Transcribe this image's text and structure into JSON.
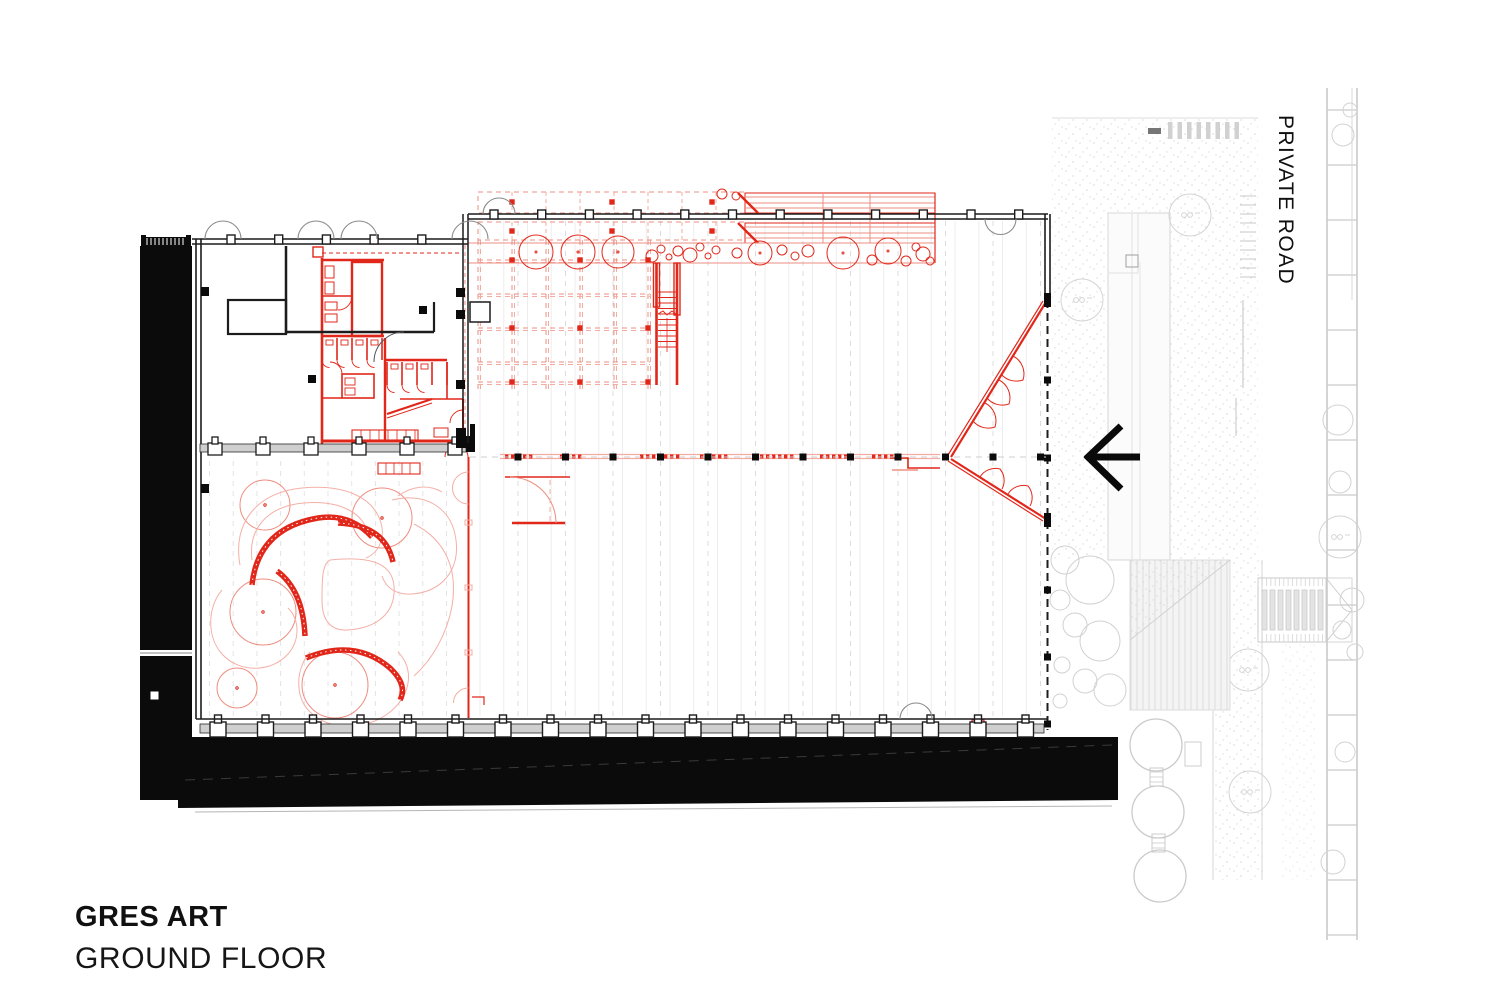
{
  "titleblock": {
    "project_title": "GRES ART",
    "sheet_title": "GROUND FLOOR"
  },
  "labels": {
    "private_road": "PRIVATE ROAD"
  },
  "icons": {
    "west_arrow": "←"
  },
  "colors": {
    "accent_red": "#e1271a",
    "light_red": "#ee8d80",
    "pale_red": "#f3aca2",
    "ink": "#0b0b0b",
    "wall_dark": "#1c1c1c",
    "door_gray": "#8a8a8a",
    "site_gray": "#cdcdcd",
    "site_light": "#dedede",
    "floor_stripe": "#ededed",
    "module_stripe": "#dcdcdc"
  }
}
